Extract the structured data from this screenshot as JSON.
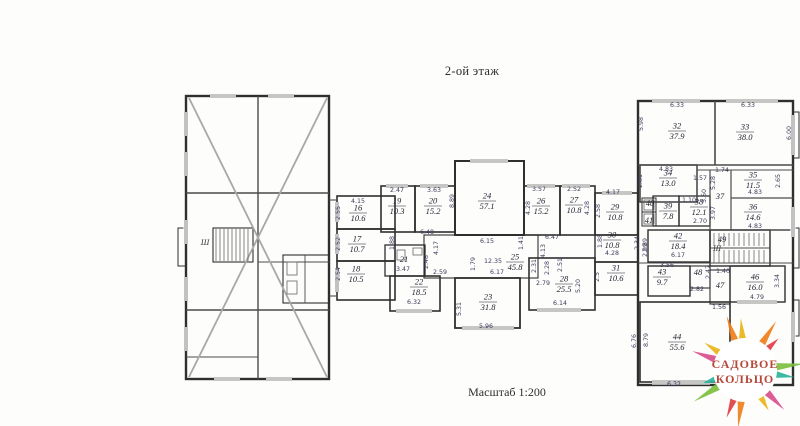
{
  "title": "2-ой этаж",
  "scale_label": "Масштаб 1:200",
  "logo": {
    "line1": "САДОВОЕ",
    "line2": "КОЛЬЦО"
  },
  "stairwells": [
    {
      "label": "Ш",
      "x": 205,
      "y": 245
    },
    {
      "label": "III",
      "x": 717,
      "y": 251
    }
  ],
  "rooms": [
    {
      "num": "16",
      "area": "10.6",
      "x": 358,
      "y": 213
    },
    {
      "num": "17",
      "area": "10.7",
      "x": 357,
      "y": 244
    },
    {
      "num": "18",
      "area": "10.5",
      "x": 356,
      "y": 274
    },
    {
      "num": "19",
      "area": "10.3",
      "x": 397,
      "y": 206
    },
    {
      "num": "20",
      "area": "15.2",
      "x": 433,
      "y": 206
    },
    {
      "num": "21",
      "area": "",
      "x": 404,
      "y": 260
    },
    {
      "num": "22",
      "area": "18.5",
      "x": 419,
      "y": 287
    },
    {
      "num": "23",
      "area": "31.8",
      "x": 488,
      "y": 302
    },
    {
      "num": "24",
      "area": "57.1",
      "x": 487,
      "y": 201
    },
    {
      "num": "25",
      "area": "45.8",
      "x": 515,
      "y": 262
    },
    {
      "num": "26",
      "area": "15.2",
      "x": 541,
      "y": 206
    },
    {
      "num": "27",
      "area": "10.8",
      "x": 574,
      "y": 205
    },
    {
      "num": "28",
      "area": "25.5",
      "x": 564,
      "y": 284
    },
    {
      "num": "29",
      "area": "10.8",
      "x": 615,
      "y": 212
    },
    {
      "num": "30",
      "area": "10.8",
      "x": 612,
      "y": 240
    },
    {
      "num": "31",
      "area": "10.6",
      "x": 616,
      "y": 273
    },
    {
      "num": "32",
      "area": "37.9",
      "x": 677,
      "y": 131
    },
    {
      "num": "33",
      "area": "38.0",
      "x": 745,
      "y": 132
    },
    {
      "num": "34",
      "area": "13.0",
      "x": 668,
      "y": 178
    },
    {
      "num": "35",
      "area": "11.5",
      "x": 753,
      "y": 180
    },
    {
      "num": "36",
      "area": "14.6",
      "x": 753,
      "y": 212
    },
    {
      "num": "37",
      "area": "",
      "x": 720,
      "y": 197
    },
    {
      "num": "38",
      "area": "12.1",
      "x": 699,
      "y": 207
    },
    {
      "num": "39",
      "area": "7.8",
      "x": 668,
      "y": 211
    },
    {
      "num": "40",
      "area": "",
      "x": 650,
      "y": 204
    },
    {
      "num": "41",
      "area": "",
      "x": 649,
      "y": 221
    },
    {
      "num": "42",
      "area": "18.4",
      "x": 678,
      "y": 241
    },
    {
      "num": "43",
      "area": "9.7",
      "x": 662,
      "y": 277
    },
    {
      "num": "44",
      "area": "55.6",
      "x": 677,
      "y": 342
    },
    {
      "num": "46",
      "area": "16.0",
      "x": 755,
      "y": 282
    },
    {
      "num": "47",
      "area": "",
      "x": 720,
      "y": 286
    },
    {
      "num": "48",
      "area": "",
      "x": 698,
      "y": 273
    },
    {
      "num": "49",
      "area": "",
      "x": 722,
      "y": 240
    }
  ],
  "dimensions": [
    {
      "t": "4.15",
      "x": 358,
      "y": 201
    },
    {
      "t": "2.55",
      "x": 338,
      "y": 213,
      "v": 1
    },
    {
      "t": "2.52",
      "x": 338,
      "y": 244,
      "v": 1
    },
    {
      "t": "2.54",
      "x": 338,
      "y": 274,
      "v": 1
    },
    {
      "t": "1.88",
      "x": 392,
      "y": 243,
      "v": 1
    },
    {
      "t": "2.47",
      "x": 397,
      "y": 190
    },
    {
      "t": "3.63",
      "x": 434,
      "y": 190
    },
    {
      "t": "6.48",
      "x": 427,
      "y": 232
    },
    {
      "t": "3.47",
      "x": 403,
      "y": 269
    },
    {
      "t": "2.48",
      "x": 426,
      "y": 262,
      "v": 1
    },
    {
      "t": "4.17",
      "x": 436,
      "y": 248,
      "v": 1
    },
    {
      "t": "2.59",
      "x": 440,
      "y": 272
    },
    {
      "t": "6.32",
      "x": 414,
      "y": 302
    },
    {
      "t": "8.89",
      "x": 452,
      "y": 201,
      "v": 1
    },
    {
      "t": "6.15",
      "x": 487,
      "y": 241
    },
    {
      "t": "12.35",
      "x": 493,
      "y": 261
    },
    {
      "t": "6.17",
      "x": 497,
      "y": 272
    },
    {
      "t": "1.79",
      "x": 473,
      "y": 264,
      "v": 1
    },
    {
      "t": "4.13",
      "x": 543,
      "y": 251,
      "v": 1
    },
    {
      "t": "2.28",
      "x": 547,
      "y": 268,
      "v": 1
    },
    {
      "t": "2.51",
      "x": 560,
      "y": 265,
      "v": 1
    },
    {
      "t": "6.47",
      "x": 552,
      "y": 237
    },
    {
      "t": "1.41",
      "x": 521,
      "y": 243,
      "v": 1
    },
    {
      "t": "5.96",
      "x": 486,
      "y": 326
    },
    {
      "t": "5.31",
      "x": 459,
      "y": 309,
      "v": 1
    },
    {
      "t": "3.57",
      "x": 539,
      "y": 189
    },
    {
      "t": "2.52",
      "x": 574,
      "y": 189
    },
    {
      "t": "4.28",
      "x": 528,
      "y": 208,
      "v": 1
    },
    {
      "t": "4.28",
      "x": 587,
      "y": 208,
      "v": 1
    },
    {
      "t": "2.58",
      "x": 598,
      "y": 211,
      "v": 1
    },
    {
      "t": "4.17",
      "x": 613,
      "y": 192
    },
    {
      "t": "1.88",
      "x": 600,
      "y": 241,
      "v": 1
    },
    {
      "t": "4.28",
      "x": 612,
      "y": 253
    },
    {
      "t": "2.34",
      "x": 637,
      "y": 243,
      "v": 1
    },
    {
      "t": "2.99",
      "x": 645,
      "y": 250,
      "v": 1
    },
    {
      "t": "2.5",
      "x": 597,
      "y": 277,
      "v": 1
    },
    {
      "t": "5.20",
      "x": 578,
      "y": 286,
      "v": 1
    },
    {
      "t": "6.14",
      "x": 560,
      "y": 303
    },
    {
      "t": "2.79",
      "x": 543,
      "y": 283
    },
    {
      "t": "2.31",
      "x": 534,
      "y": 266,
      "v": 1
    },
    {
      "t": "6.33",
      "x": 677,
      "y": 105
    },
    {
      "t": "6.33",
      "x": 748,
      "y": 105
    },
    {
      "t": "5.98",
      "x": 641,
      "y": 124,
      "v": 1
    },
    {
      "t": "6.00",
      "x": 789,
      "y": 133,
      "v": 1
    },
    {
      "t": "4.83",
      "x": 666,
      "y": 169
    },
    {
      "t": "2.81",
      "x": 640,
      "y": 181,
      "v": 1
    },
    {
      "t": "1.57",
      "x": 700,
      "y": 178
    },
    {
      "t": "1.74",
      "x": 722,
      "y": 170
    },
    {
      "t": "4.83",
      "x": 755,
      "y": 192
    },
    {
      "t": "5.28",
      "x": 713,
      "y": 183,
      "v": 1
    },
    {
      "t": "2.65",
      "x": 778,
      "y": 181,
      "v": 1
    },
    {
      "t": "5.60",
      "x": 704,
      "y": 196,
      "v": 1
    },
    {
      "t": "3.97",
      "x": 713,
      "y": 213,
      "v": 1
    },
    {
      "t": "4.83",
      "x": 755,
      "y": 226
    },
    {
      "t": "1.10",
      "x": 689,
      "y": 200
    },
    {
      "t": "2.70",
      "x": 700,
      "y": 221
    },
    {
      "t": "6.17",
      "x": 678,
      "y": 255
    },
    {
      "t": "2.89",
      "x": 645,
      "y": 245,
      "v": 1
    },
    {
      "t": "3.56",
      "x": 667,
      "y": 265
    },
    {
      "t": "2.47",
      "x": 708,
      "y": 272,
      "v": 1
    },
    {
      "t": "2.82",
      "x": 697,
      "y": 289
    },
    {
      "t": "1.40",
      "x": 723,
      "y": 271
    },
    {
      "t": "4.79",
      "x": 757,
      "y": 297
    },
    {
      "t": "3.34",
      "x": 777,
      "y": 281,
      "v": 1
    },
    {
      "t": "1.56",
      "x": 719,
      "y": 307
    },
    {
      "t": "8.79",
      "x": 646,
      "y": 340,
      "v": 1
    },
    {
      "t": "6.32",
      "x": 674,
      "y": 384
    },
    {
      "t": "6.76",
      "x": 634,
      "y": 341,
      "v": 1
    }
  ],
  "colors": {
    "wall": "#2f2f2f",
    "thin_wall": "#4b4b4b",
    "diagonal": "#a8a8a8",
    "dim_text": "#3d3d5c",
    "room_text": "#1f1f2e",
    "logo_text": "#b5483a",
    "logo_palette": [
      "#e8b417",
      "#ef7f1a",
      "#df3f45",
      "#7cbf3f",
      "#2ab39b",
      "#d94f8b"
    ]
  }
}
